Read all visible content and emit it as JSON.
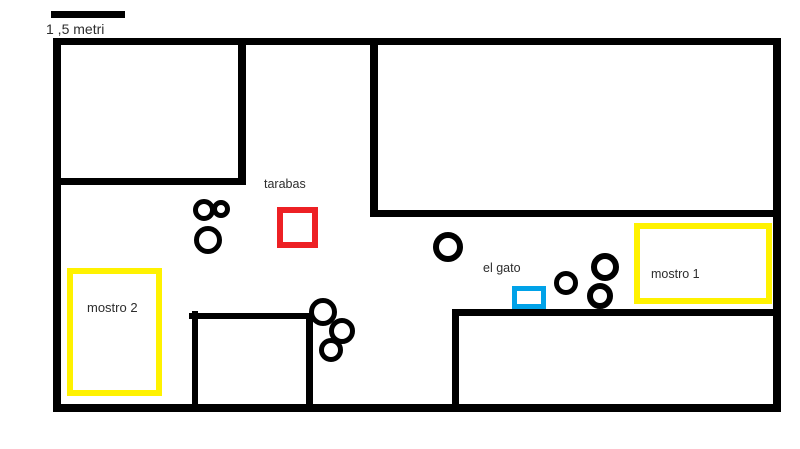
{
  "title": "floor-plan sketch",
  "scale": {
    "label": "1 ,5 metri",
    "bar": {
      "x": 51,
      "y": 11,
      "w": 74,
      "h": 7
    }
  },
  "labels": {
    "tarabas": "tarabas",
    "el_gato": "el gato",
    "mostro_1": "mostro 1",
    "mostro_2": "mostro 2"
  },
  "colors": {
    "wall": "#000000",
    "tarabas_red": "#ED2024",
    "el_gato_blue": "#00A2E8",
    "mostro_yellow": "#FFF200",
    "text": "#2d2d2d"
  },
  "diagram": {
    "walls": [
      {
        "name": "outer-wall-top",
        "x": 53,
        "y": 38,
        "w": 728,
        "h": 7
      },
      {
        "name": "outer-wall-left",
        "x": 53,
        "y": 38,
        "w": 8,
        "h": 374
      },
      {
        "name": "outer-wall-right",
        "x": 773,
        "y": 38,
        "w": 8,
        "h": 374
      },
      {
        "name": "outer-wall-bottom",
        "x": 53,
        "y": 404,
        "w": 728,
        "h": 8
      },
      {
        "name": "top-left-room-wall-right",
        "x": 238,
        "y": 38,
        "w": 8,
        "h": 147
      },
      {
        "name": "top-left-room-wall-bottom",
        "x": 53,
        "y": 178,
        "w": 193,
        "h": 7
      },
      {
        "name": "top-right-room-wall-left",
        "x": 370,
        "y": 38,
        "w": 8,
        "h": 179
      },
      {
        "name": "top-right-room-wall-bottom",
        "x": 370,
        "y": 210,
        "w": 411,
        "h": 7
      },
      {
        "name": "bottom-right-room-wall-top",
        "x": 452,
        "y": 309,
        "w": 329,
        "h": 7
      },
      {
        "name": "bottom-right-room-wall-left",
        "x": 452,
        "y": 309,
        "w": 7,
        "h": 102
      },
      {
        "name": "middle-room-wall-top",
        "x": 189,
        "y": 313,
        "w": 124,
        "h": 6
      },
      {
        "name": "middle-room-wall-left",
        "x": 192,
        "y": 311,
        "w": 6,
        "h": 100
      },
      {
        "name": "middle-room-wall-right",
        "x": 306,
        "y": 313,
        "w": 7,
        "h": 98
      }
    ],
    "circles": [
      {
        "cx": 204,
        "cy": 210,
        "r": 11,
        "stroke": 5
      },
      {
        "cx": 221,
        "cy": 209,
        "r": 9,
        "stroke": 5
      },
      {
        "cx": 208,
        "cy": 240,
        "r": 14,
        "stroke": 5
      },
      {
        "cx": 448,
        "cy": 247,
        "r": 15,
        "stroke": 6
      },
      {
        "cx": 566,
        "cy": 283,
        "r": 12,
        "stroke": 5
      },
      {
        "cx": 605,
        "cy": 267,
        "r": 14,
        "stroke": 6
      },
      {
        "cx": 600,
        "cy": 296,
        "r": 13,
        "stroke": 6
      },
      {
        "cx": 323,
        "cy": 312,
        "r": 14,
        "stroke": 5
      },
      {
        "cx": 342,
        "cy": 331,
        "r": 13,
        "stroke": 5
      },
      {
        "cx": 331,
        "cy": 350,
        "r": 12,
        "stroke": 5
      }
    ],
    "boxes": [
      {
        "name": "tarabas-box",
        "x": 277,
        "y": 207,
        "w": 41,
        "h": 41,
        "stroke": 6,
        "color": "#ED2024"
      },
      {
        "name": "el-gato-box",
        "x": 512,
        "y": 286,
        "w": 34,
        "h": 23,
        "stroke": 5,
        "color": "#00A2E8"
      },
      {
        "name": "mostro-1-box",
        "x": 634,
        "y": 223,
        "w": 138,
        "h": 81,
        "stroke": 6,
        "color": "#FFF200"
      },
      {
        "name": "mostro-2-box",
        "x": 67,
        "y": 268,
        "w": 95,
        "h": 128,
        "stroke": 6,
        "color": "#FFF200"
      }
    ]
  }
}
